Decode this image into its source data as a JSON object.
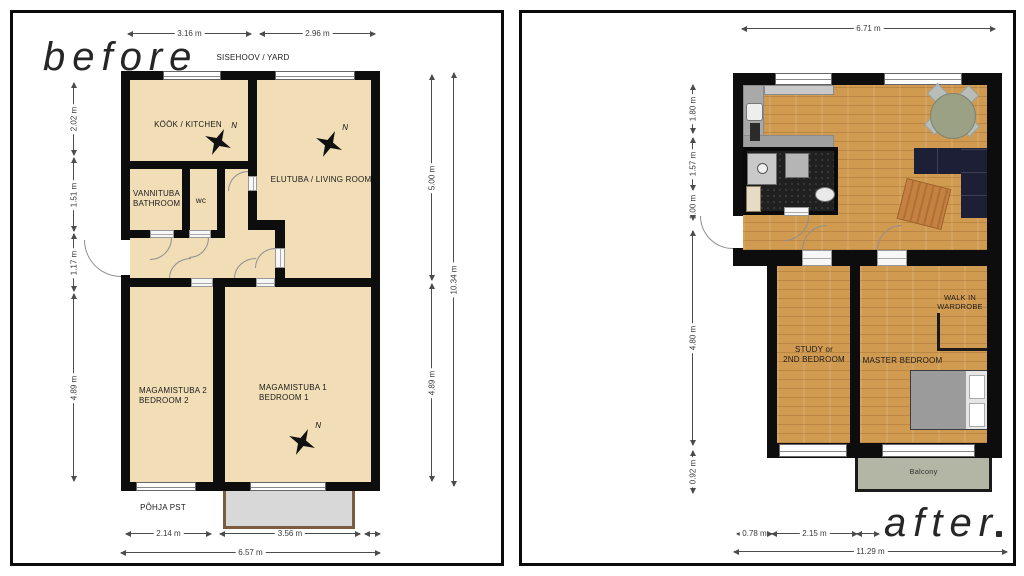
{
  "before": {
    "title": "before",
    "yard_label": "SISEHOOV / YARD",
    "street_label": "PÕHJA PST",
    "compass_n": "N",
    "rooms": {
      "kitchen": "KÖÖK / KITCHEN",
      "living": "ELUTUBA / LIVING ROOM",
      "bathroom_l1": "VANNITUBA",
      "bathroom_l2": "BATHROOM",
      "wc": "wc",
      "bedroom2_l1": "MAGAMISTUBA 2",
      "bedroom2_l2": "BEDROOM 2",
      "bedroom1_l1": "MAGAMISTUBA 1",
      "bedroom1_l2": "BEDROOM 1"
    },
    "dims": {
      "top1": "3.16 m",
      "top2": "2.96 m",
      "left1": "2.02 m",
      "left2": "1.51 m",
      "left3": "1.17 m",
      "left4": "4.89 m",
      "right1": "5.00 m",
      "right2": "4.89 m",
      "right_total": "10.34 m",
      "bottom1": "2.14 m",
      "bottom2": "3.56 m",
      "bottom_total": "6.57 m"
    }
  },
  "after": {
    "title": "after",
    "rooms": {
      "study_l1": "STUDY or",
      "study_l2": "2ND BEDROOM",
      "master": "MASTER BEDROOM",
      "wardrobe_l1": "WALK IN",
      "wardrobe_l2": "WARDROBE",
      "balcony": "Balcony"
    },
    "dims": {
      "top": "6.71 m",
      "left1": "1.80 m",
      "left2": "1.57 m",
      "left3": "1.00 m",
      "left4": "4.80 m",
      "left5": "0.92 m",
      "bottom1": "0.78 m",
      "bottom2": "2.15 m",
      "bottom_total": "11.29 m"
    }
  },
  "colors": {
    "wall": "#0d0d0d",
    "floor_before": "#f1ddb6",
    "floor_wood": "#d09a50",
    "balcony_before": "#d8d8d8",
    "balcony_before_border": "#7b5c40",
    "balcony_after": "#b4b6a5",
    "bathroom_floor": "#202020",
    "sofa": "#1d1f36",
    "rug": "#c48141",
    "table": "#9aa184",
    "bed_mattress": "#9b9b9b",
    "dimension_line": "#4c4c4c"
  }
}
